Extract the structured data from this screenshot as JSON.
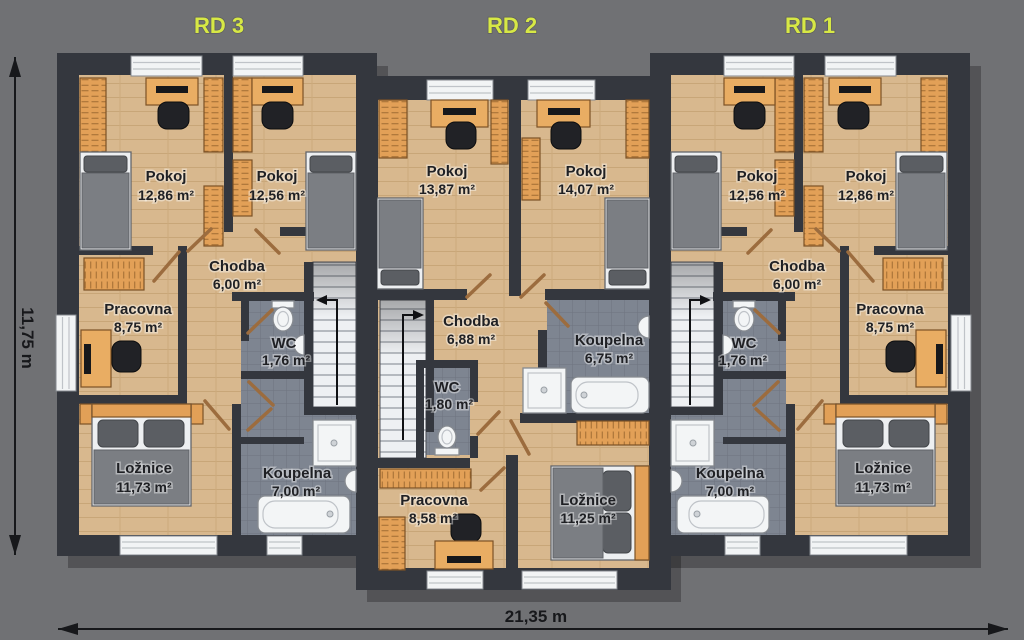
{
  "dimensions": {
    "width": "21,35 m",
    "height": "11,75 m"
  },
  "houses": {
    "rd3": {
      "label": "RD 3",
      "rooms": {
        "pokoj1": {
          "name": "Pokoj",
          "area": "12,86 m²"
        },
        "pokoj2": {
          "name": "Pokoj",
          "area": "12,56 m²"
        },
        "chodba": {
          "name": "Chodba",
          "area": "6,00 m²"
        },
        "pracovna": {
          "name": "Pracovna",
          "area": "8,75 m²"
        },
        "wc": {
          "name": "WC",
          "area": "1,76 m²"
        },
        "loznice": {
          "name": "Ložnice",
          "area": "11,73 m²"
        },
        "koupelna": {
          "name": "Koupelna",
          "area": "7,00 m²"
        }
      }
    },
    "rd2": {
      "label": "RD 2",
      "rooms": {
        "pokoj1": {
          "name": "Pokoj",
          "area": "13,87 m²"
        },
        "pokoj2": {
          "name": "Pokoj",
          "area": "14,07 m²"
        },
        "chodba": {
          "name": "Chodba",
          "area": "6,88 m²"
        },
        "wc": {
          "name": "WC",
          "area": "1,80 m²"
        },
        "koupelna": {
          "name": "Koupelna",
          "area": "6,75 m²"
        },
        "pracovna": {
          "name": "Pracovna",
          "area": "8,58 m²"
        },
        "loznice": {
          "name": "Ložnice",
          "area": "11,25 m²"
        }
      }
    },
    "rd1": {
      "label": "RD 1",
      "rooms": {
        "pokoj1": {
          "name": "Pokoj",
          "area": "12,56 m²"
        },
        "pokoj2": {
          "name": "Pokoj",
          "area": "12,86 m²"
        },
        "chodba": {
          "name": "Chodba",
          "area": "6,00 m²"
        },
        "wc": {
          "name": "WC",
          "area": "1,76 m²"
        },
        "pracovna": {
          "name": "Pracovna",
          "area": "8,75 m²"
        },
        "koupelna": {
          "name": "Koupelna",
          "area": "7,00 m²"
        },
        "loznice": {
          "name": "Ložnice",
          "area": "11,73 m²"
        }
      }
    }
  },
  "colors": {
    "background": "#707174",
    "wall": "#34373e",
    "floor": "#d8b88e",
    "tile": "#7e8591",
    "house_label": "#d7e845",
    "furniture_orange": "#e2a057"
  }
}
